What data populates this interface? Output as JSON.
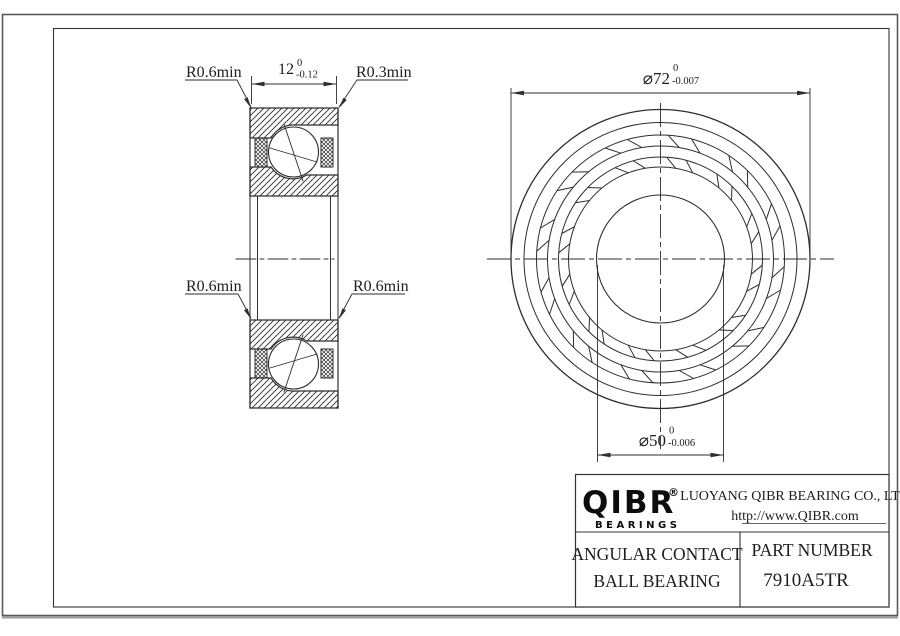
{
  "drawing": {
    "section_view": {
      "label_top_left": "R0.6min",
      "label_top_right": "R0.3min",
      "label_mid_left": "R0.6min",
      "label_mid_right": "R0.6min",
      "width_dim": {
        "value": "12",
        "tol_upper": "0",
        "tol_lower": "-0.12"
      }
    },
    "front_view": {
      "od_dim": {
        "value": "⌀72",
        "tol_upper": "0",
        "tol_lower": "-0.007"
      },
      "bore_dim": {
        "value": "⌀50",
        "tol_upper": "0",
        "tol_lower": "-0.006"
      }
    }
  },
  "title_block": {
    "logo_text": "QIBR",
    "logo_registered": "®",
    "logo_subtext": "BEARINGS",
    "company_name": "LUOYANG QIBR BEARING CO., LTD",
    "website": "http://www.QIBR.com",
    "product_type_line1": "ANGULAR CONTACT",
    "product_type_line2": "BALL BEARING",
    "part_number_label": "PART NUMBER",
    "part_number": "7910A5TR"
  },
  "colors": {
    "line": "#2e2e2e",
    "frame": "#555555",
    "background": "#ffffff"
  }
}
